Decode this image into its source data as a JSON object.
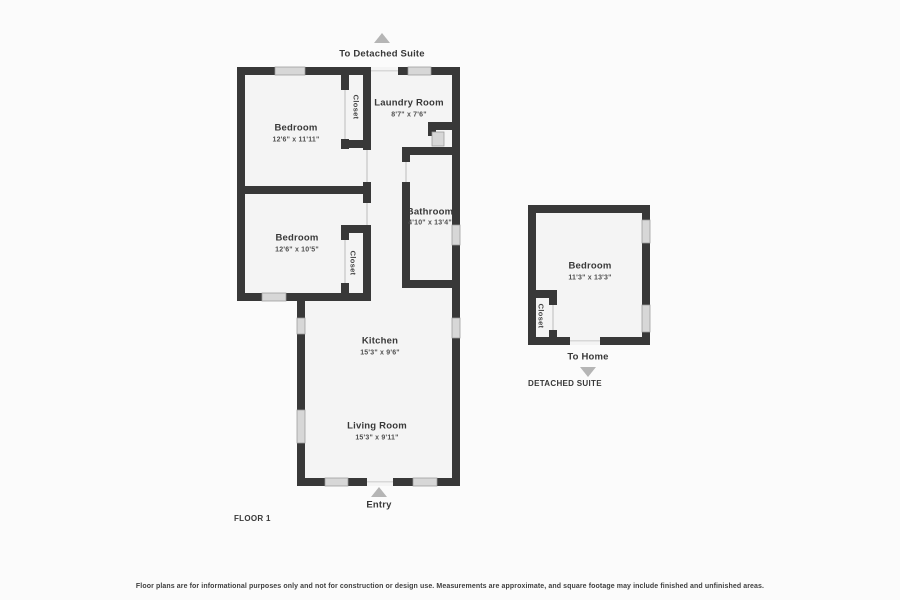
{
  "plan": {
    "floor_label": "FLOOR 1",
    "detached_suite_label": "DETACHED SUITE",
    "closet": "Closet",
    "nav": {
      "to_detached_suite": "To Detached Suite",
      "to_home": "To Home",
      "entry": "Entry"
    },
    "rooms": [
      {
        "name": "Bedroom",
        "dims": "12'6\" x 11'11\""
      },
      {
        "name": "Laundry Room",
        "dims": "8'7\" x 7'6\""
      },
      {
        "name": "Bathroom",
        "dims": "4'10\" x 13'4\""
      },
      {
        "name": "Bedroom",
        "dims": "12'6\" x 10'5\""
      },
      {
        "name": "Kitchen",
        "dims": "15'3\" x 9'6\""
      },
      {
        "name": "Living Room",
        "dims": "15'3\" x 9'11\""
      },
      {
        "name": "Bedroom",
        "dims": "11'3\" x 13'3\""
      }
    ],
    "disclaimer": "Floor plans are for informational purposes only and not for construction or design use. Measurements are approximate, and square footage may include finished and unfinished areas.",
    "colors": {
      "wall": "#383838",
      "window": "#d7d7d7",
      "room_fill": "#f4f4f4",
      "arrow": "#b5b5b5",
      "text": "#3a3a3a"
    }
  }
}
